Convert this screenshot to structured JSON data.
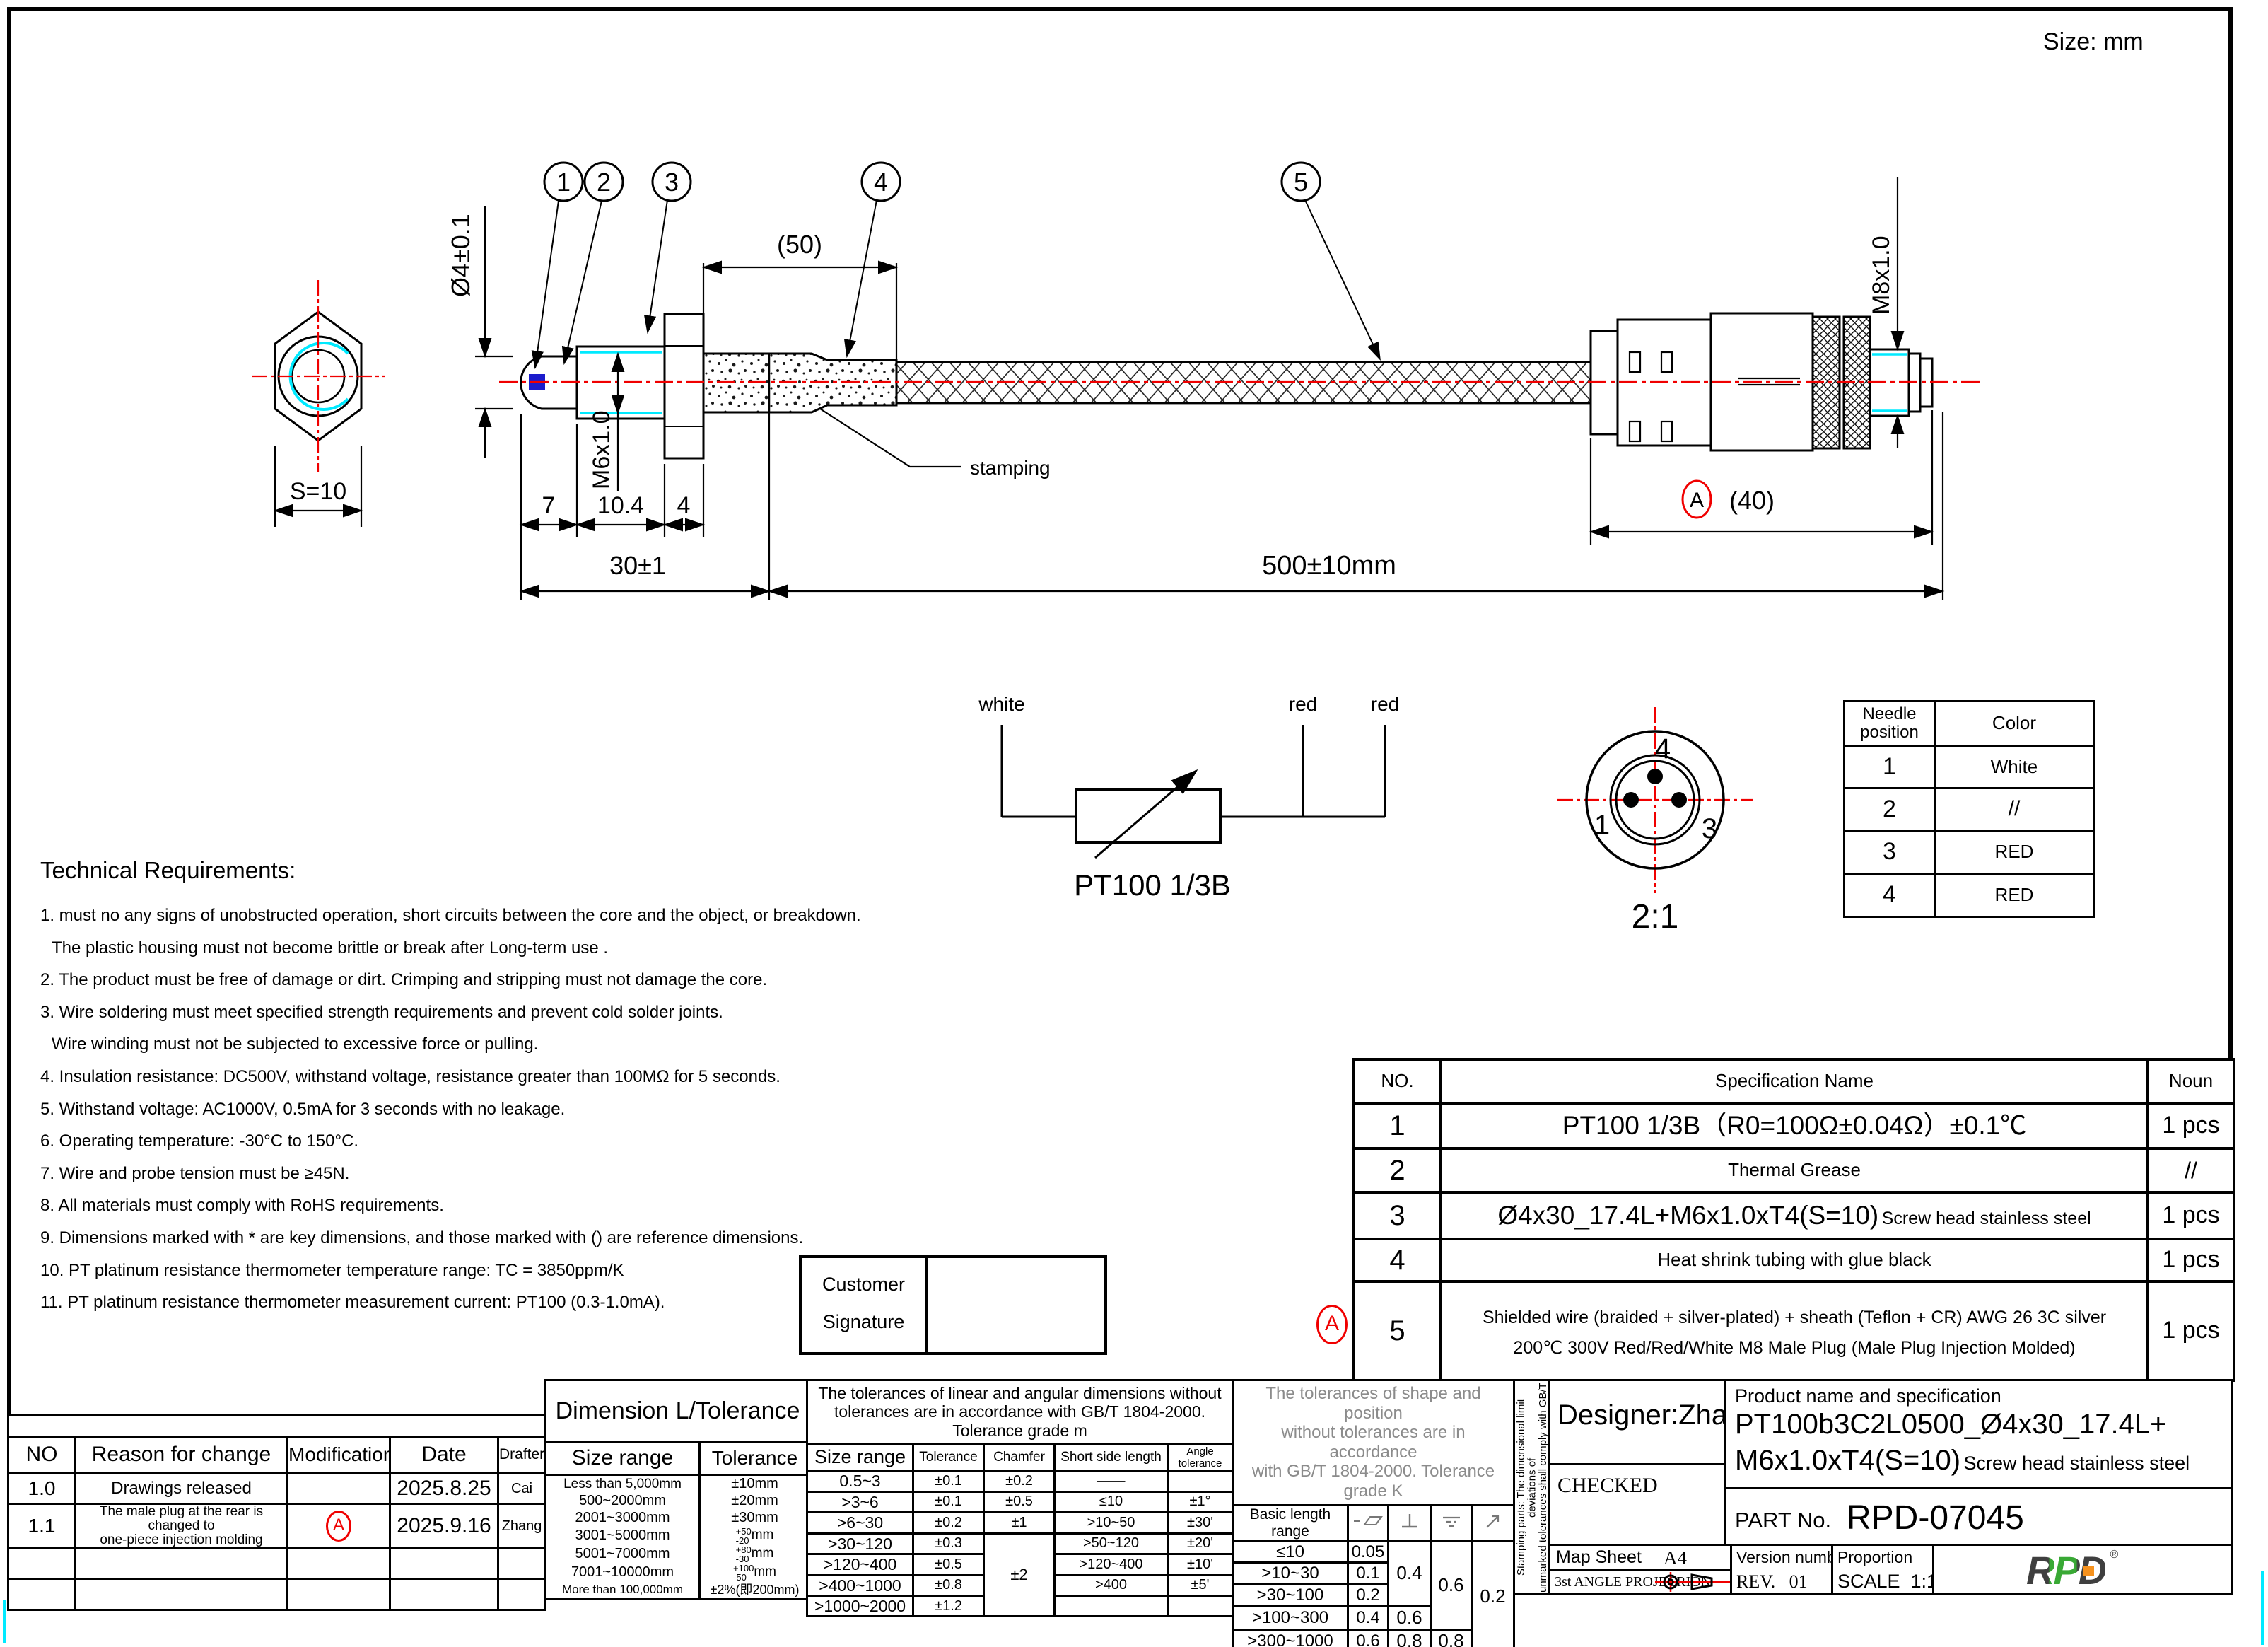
{
  "frame": {
    "size_label": "Size: mm"
  },
  "drawing": {
    "balloon1": "1",
    "balloon2": "2",
    "balloon3": "3",
    "balloon4": "4",
    "balloon5": "5",
    "dia4": "Ø4±0.1",
    "ref50": "(50)",
    "dim7": "7",
    "dim104": "10.4",
    "dim4": "4",
    "dim30": "30±1",
    "dim500": "500±10mm",
    "m6": "M6x1.0",
    "m8": "M8x1.0",
    "s10": "S=10",
    "ref40": "(40)",
    "rev_a": "A",
    "stamping": "stamping"
  },
  "schematic": {
    "wire_white": "white",
    "wire_red1": "red",
    "wire_red2": "red",
    "label": "PT100 1/3B"
  },
  "face": {
    "pin1": "1",
    "pin3": "3",
    "pin4": "4",
    "scale": "2:1"
  },
  "needle_table": {
    "header_pos": "Needle position",
    "header_color": "Color",
    "rows": [
      {
        "pos": "1",
        "color": "White"
      },
      {
        "pos": "2",
        "color": "//"
      },
      {
        "pos": "3",
        "color": "RED"
      },
      {
        "pos": "4",
        "color": "RED"
      }
    ]
  },
  "tech": {
    "title": "Technical Requirements:",
    "lines": [
      "1. must no any signs of unobstructed operation, short circuits between the core and the object, or breakdown.",
      "The plastic housing must not become brittle or break after Long-term use .",
      "2. The product must be free of damage or dirt. Crimping and stripping must not damage the core.",
      "3. Wire soldering must meet specified strength requirements and prevent cold solder joints.",
      "Wire winding must not be subjected to excessive force or pulling.",
      "4. Insulation resistance: DC500V, withstand voltage, resistance greater than 100MΩ for 5 seconds.",
      "5. Withstand voltage: AC1000V, 0.5mA for 3 seconds with no leakage.",
      "6. Operating temperature: -30°C to 150°C.",
      "7. Wire and probe tension must be ≥45N.",
      "8. All materials must comply with RoHS requirements.",
      "9. Dimensions marked with * are key dimensions, and those marked with () are reference dimensions.",
      "10. PT platinum resistance thermometer temperature range: TC = 3850ppm/K",
      "11. PT platinum resistance thermometer measurement current: PT100 (0.3-1.0mA)."
    ]
  },
  "spec_table": {
    "h_no": "NO.",
    "h_name": "Specification Name",
    "h_noun": "Noun",
    "r1_no": "1",
    "r1_name": "PT100 1/3B（R0=100Ω±0.04Ω）±0.1℃",
    "r1_noun": "1 pcs",
    "r2_no": "2",
    "r2_name": "Thermal Grease",
    "r2_noun": "//",
    "r3_no": "3",
    "r3_name": "Ø4x30_17.4L+M6x1.0xT4(S=10)",
    "r3_name_sub": "Screw head stainless steel",
    "r3_noun": "1 pcs",
    "r4_no": "4",
    "r4_name": "Heat shrink tubing with glue black",
    "r4_noun": "1 pcs",
    "r5_no": "5",
    "r5_line1": "Shielded wire (braided + silver-plated) + sheath (Teflon + CR)  AWG 26 3C  silver",
    "r5_line2": "200℃ 300V Red/Red/White M8 Male Plug (Male Plug Injection Molded)",
    "r5_noun": "1 pcs",
    "balloon_a": "A"
  },
  "signature": {
    "line1": "Customer",
    "line2": "Signature"
  },
  "revision": {
    "h_no": "NO",
    "h_reason": "Reason for change",
    "h_mod": "Modification",
    "h_date": "Date",
    "h_drafter": "Drafter",
    "r1_no": "1.0",
    "r1_reason": "Drawings released",
    "r1_mod": "",
    "r1_date": "2025.8.25",
    "r1_drafter": "Cai",
    "r2_no": "1.1",
    "r2_reason1": "The male plug at the rear is changed to",
    "r2_reason2": "one-piece injection molding",
    "r2_mod": "A",
    "r2_date": "2025.9.16",
    "r2_drafter": "Zhang"
  },
  "dim_tol": {
    "title": "Dimension L/Tolerance",
    "h_range": "Size range",
    "h_tol": "Tolerance",
    "rows": [
      {
        "range": "Less than 5,000mm",
        "tol": "±10mm"
      },
      {
        "range": "500~2000mm",
        "tol": "±20mm"
      },
      {
        "range": "2001~3000mm",
        "tol": "±30mm"
      },
      {
        "range": "3001~5000mm",
        "sup": "+50",
        "sub": "-20",
        "unit": "mm"
      },
      {
        "range": "5001~7000mm",
        "sup": "+80",
        "sub": "-30",
        "unit": "mm"
      },
      {
        "range": "7001~10000mm",
        "sup": "+100",
        "sub": "-50",
        "unit": "mm"
      },
      {
        "range": "More than 100,000mm",
        "tol": "±2%(即200mm)"
      }
    ]
  },
  "linear_tol": {
    "note1": "The tolerances of linear and angular dimensions without",
    "note2": "tolerances are in accordance with GB/T 1804-2000.",
    "note3": "Tolerance grade m",
    "h_range": "Size range",
    "h_tol": "Tolerance",
    "h_chamfer": "Chamfer",
    "h_short": "Short side length",
    "h_angle": "Angle tolerance",
    "rows": [
      {
        "range": "0.5~3",
        "tol": "±0.1",
        "chamfer": "±0.2",
        "short": "——",
        "angle": ""
      },
      {
        "range": ">3~6",
        "tol": "±0.1",
        "chamfer": "±0.5",
        "short": "≤10",
        "angle": "±1°"
      },
      {
        "range": ">6~30",
        "tol": "±0.2",
        "chamfer": "±1",
        "short": ">10~50",
        "angle": "±30'"
      },
      {
        "range": ">30~120",
        "tol": "±0.3",
        "chamfer": "±2",
        "short": ">50~120",
        "angle": "±20'"
      },
      {
        "range": ">120~400",
        "tol": "±0.5",
        "short": ">120~400",
        "angle": "±10'"
      },
      {
        "range": ">400~1000",
        "tol": "±0.8",
        "short": ">400",
        "angle": "±5'"
      },
      {
        "range": ">1000~2000",
        "tol": "±1.2",
        "short": "",
        "angle": ""
      }
    ]
  },
  "shape_tol": {
    "note1": "The tolerances of shape and position",
    "note2": "without tolerances are in accordance",
    "note3": "with GB/T 1804-2000. Tolerance grade K",
    "h_range": "Basic length range",
    "rows": [
      {
        "range": "≤10",
        "straight": "0.05",
        "perp": "0.4",
        "sym": "0.6",
        "runout": "0.2"
      },
      {
        "range": ">10~30",
        "straight": "0.1"
      },
      {
        "range": ">30~100",
        "straight": "0.2"
      },
      {
        "range": ">100~300",
        "straight": "0.4",
        "perp": "0.6"
      },
      {
        "range": ">300~1000",
        "straight": "0.6",
        "perp": "0.8",
        "sym": "0.8"
      }
    ]
  },
  "stamping_note": {
    "line1": "Stamping parts: The dimensional limit deviations of",
    "line2": "unmarked tolerances shall comply with GB/T",
    "line3": "15055-2007. Tolerance grade m"
  },
  "title_block": {
    "designer": "Designer:Zhang",
    "checked": "CHECKED",
    "map_sheet": "Map Sheet",
    "map_value": "A4",
    "projection": "3st ANGLE PROJECRION",
    "product_label": "Product name and specification",
    "product1": "PT100b3C2L0500_Ø4x30_17.4L+",
    "product2": "M6x1.0xT4(S=10)",
    "product2_sub": "Screw head stainless steel",
    "part_label": "PART No.",
    "part_value": "RPD-07045",
    "version_label": "Version number",
    "version_value": "REV.   01",
    "proportion_label": "Proportion",
    "proportion_value": "SCALE  1:1",
    "logo": "RPD"
  }
}
